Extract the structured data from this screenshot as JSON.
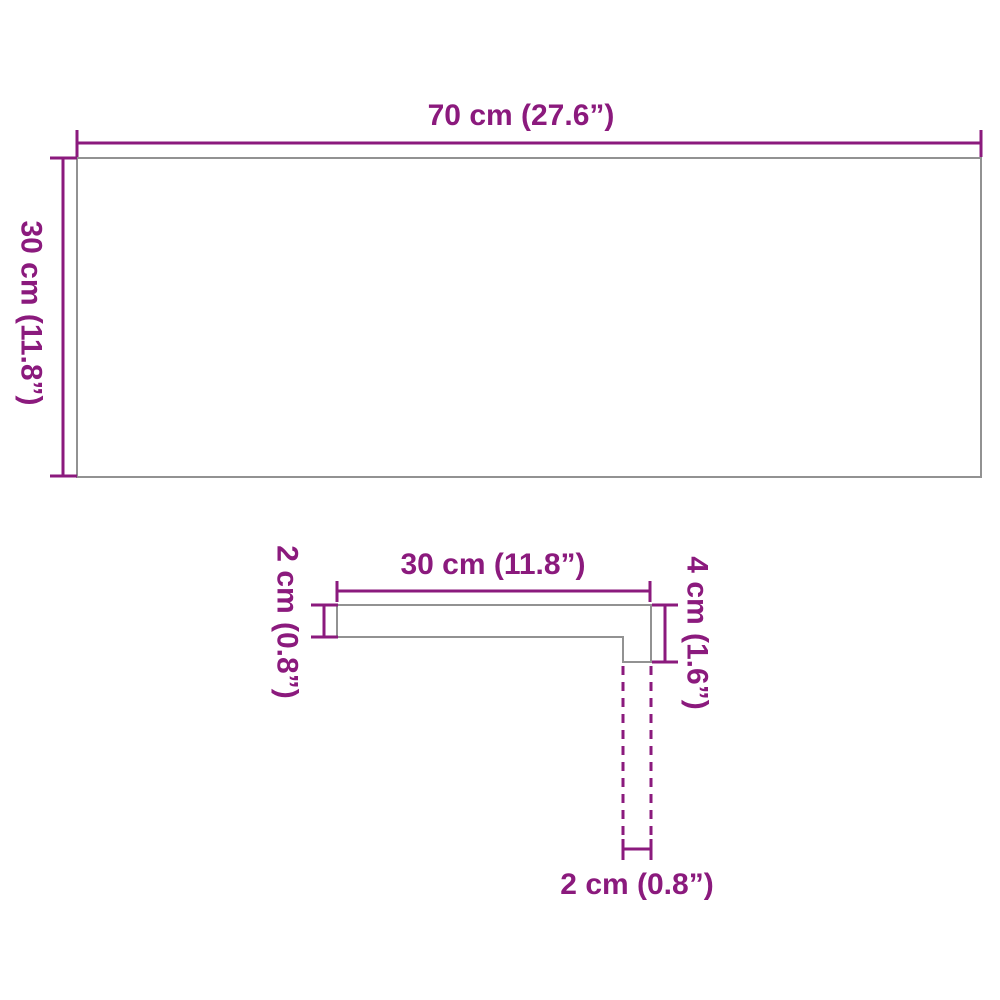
{
  "colors": {
    "dimension-color": "#8b1a7d",
    "outline-color": "#929292",
    "background-color": "#ffffff"
  },
  "top_view": {
    "width_label": "70 cm (27.6”)",
    "depth_label": "30 cm (11.8”)"
  },
  "profile_view": {
    "tread_depth_label": "30 cm (11.8”)",
    "panel_thickness_label": "2 cm (0.8”)",
    "nosing_height_label": "4 cm (1.6”)",
    "riser_thickness_label": "2 cm (0.8”)"
  }
}
